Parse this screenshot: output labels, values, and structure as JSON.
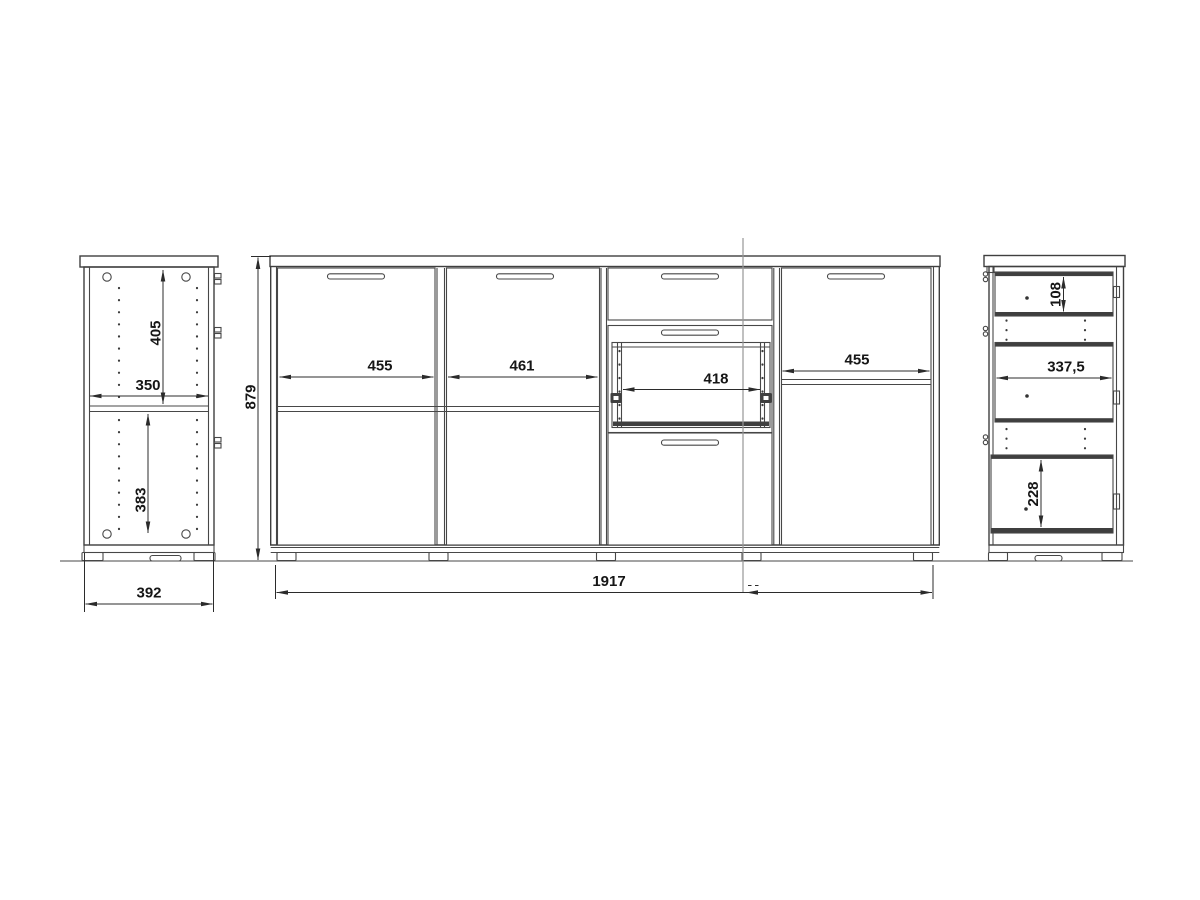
{
  "document": {
    "type": "furniture-technical-drawing",
    "subject": "sideboard with doors and drawers, three orthographic views"
  },
  "views": {
    "left_side": {
      "dims": {
        "upper_inner_height": "405",
        "inner_width": "350",
        "lower_inner_height": "383",
        "depth": "392"
      }
    },
    "front": {
      "dims": {
        "height": "879",
        "left_door_width": "455",
        "center_door_width": "461",
        "drawer_inner_width": "418",
        "right_door_width": "455",
        "total_width": "1917"
      }
    },
    "right_side": {
      "dims": {
        "top_drawer_height": "108",
        "drawer_depth": "337,5",
        "bottom_drawer_height": "228"
      }
    }
  },
  "colors": {
    "line": "#3f3f3f",
    "dimension_text": "#161616",
    "centerline": "#979797",
    "background": "#ffffff"
  }
}
